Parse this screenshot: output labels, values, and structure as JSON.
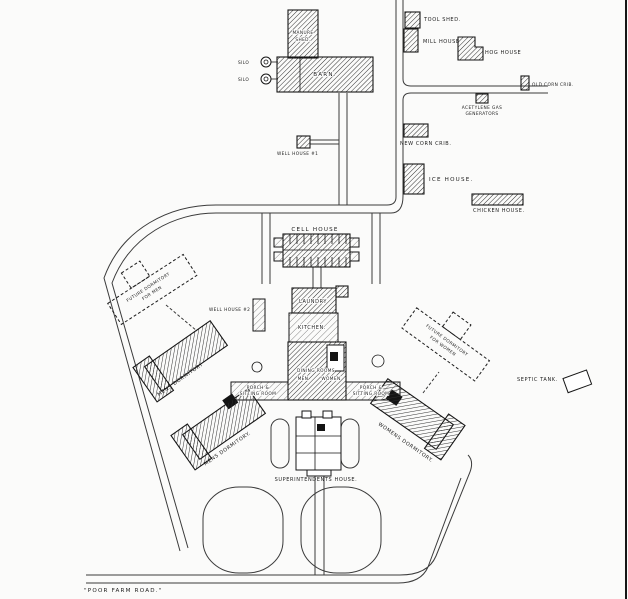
{
  "title": "Poor farm site plan drawing",
  "colors": {
    "ink": "#1c1c1c",
    "road": "#3b3b3b",
    "background": "#fbfbfa",
    "building_fill": "#2e2e2e"
  },
  "labels": {
    "manure_shed_1": "MANURE",
    "manure_shed_2": "SHED.",
    "barn": "BARN.",
    "silo_1": "SILO",
    "silo_2": "SILO",
    "tool_shed": "TOOL SHED.",
    "mill_house": "MILL HOUSE",
    "hog_house": "HOG HOUSE",
    "old_corn_crib": "OLD CORN CRIB.",
    "acetylene_1": "ACETYLENE GAS",
    "acetylene_2": "GENERATORS",
    "new_corn_crib": "NEW CORN CRIB.",
    "well_house_1": "WELL HOUSE #1",
    "ice_house": "ICE HOUSE.",
    "chicken_house": "CHICKEN HOUSE.",
    "cell_house": "CELL HOUSE",
    "future_dorm_men_1": "FUTURE DORMITORY",
    "future_dorm_men_2": "FOR MEN",
    "well_house_2": "WELL HOUSE #2",
    "laundry": "LAUNDRY",
    "kitchen": "KITCHEN.",
    "dining_1": "DINING ROOMS",
    "dining_2": "MEN",
    "dining_3": "WOMEN",
    "porch_left_1": "PORCH &",
    "porch_left_2": "SITTING ROOM",
    "porch_right_1": "PORCH &",
    "porch_right_2": "SITTING ROOM",
    "mens_dorm_upper": "MENS DORMITORY",
    "mens_dorm_lower": "MENS DORMITORY.",
    "womens_dorm": "WOMENS DORMITORY.",
    "future_dorm_women_1": "FUTURE DORMITORY",
    "future_dorm_women_2": "FOR WOMEN",
    "septic_tank": "SEPTIC TANK.",
    "superintendents_house": "SUPERINTENDENTS HOUSE.",
    "poor_farm_road": "\"POOR FARM ROAD.\""
  }
}
